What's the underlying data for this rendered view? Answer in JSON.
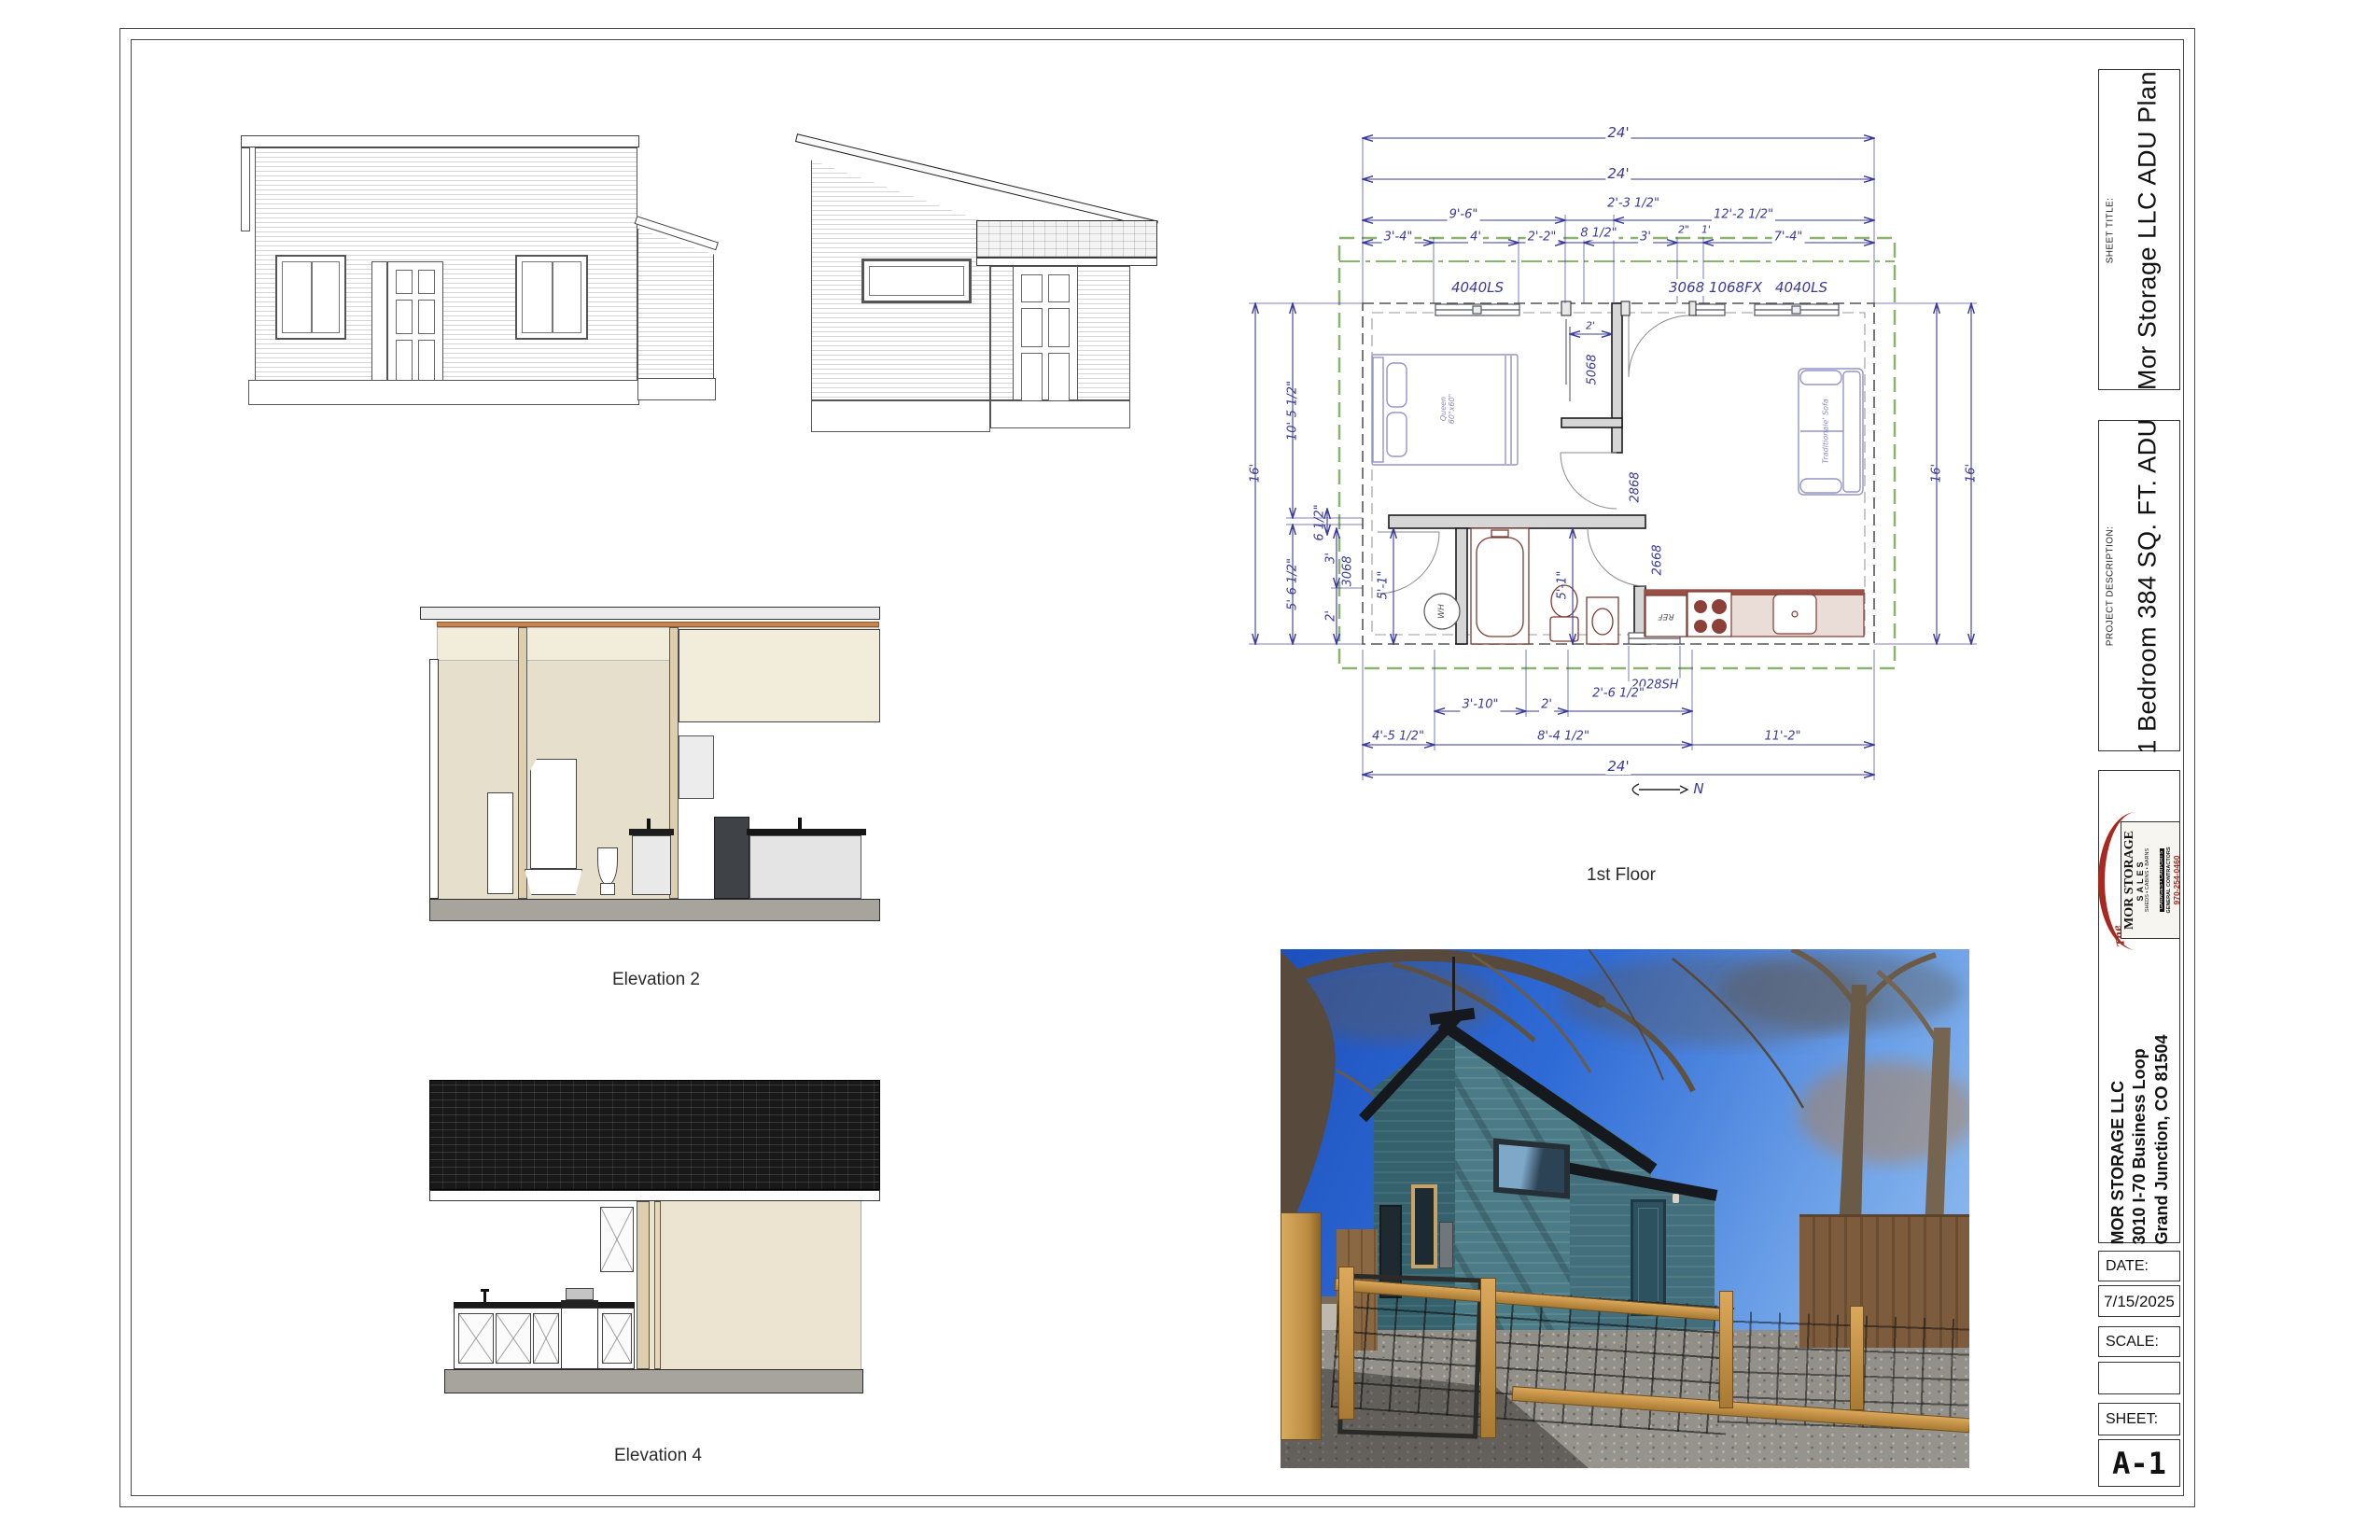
{
  "titleblock": {
    "sheet_title_label": "SHEET TITLE:",
    "sheet_title": "Mor Storage LLC ADU Plan",
    "project_description_label": "PROJECT DESCRIPTION:",
    "project_description": "1 Bedroom 384 SQ. FT. ADU",
    "logo": {
      "prefix": "The",
      "brand": "MOR STORAGE",
      "sub": "SALES",
      "products1": "SHEDS • CABINS • BARNS",
      "products2": "GARAGES • CARPORTS",
      "role": "GENERAL CONTRACTORS",
      "phone": "970-254-0460"
    },
    "company_name": "MOR STORAGE LLC",
    "company_address1": "3010 I-70 Business Loop",
    "company_address2": "Grand Junction, CO 81504",
    "date_label": "DATE:",
    "date_value": "7/15/2025",
    "scale_label": "SCALE:",
    "scale_value": "",
    "sheet_label": "SHEET:",
    "sheet_number": "A-1"
  },
  "plan": {
    "caption": "1st Floor",
    "north_label": "N",
    "dims": {
      "t24a": "24'",
      "t24b": "24'",
      "t96": "9'-6\"",
      "t2312": "2'-3 1/2\"",
      "t12212": "12'-2 1/2\"",
      "t34": "3'-4\"",
      "t4": "4'",
      "t22": "2'-2\"",
      "t812": "8 1/2\"",
      "t3": "3'",
      "t2in": "2\"",
      "t1": "1'",
      "t74": "7'-4\"",
      "l16": "16'",
      "l10512": "10'-5 1/2\"",
      "l612": "6 1/2\"",
      "l5612": "5'-6 1/2\"",
      "l3": "3'",
      "l2": "2'",
      "r16a": "16'",
      "r16b": "16'",
      "b310": "3'-10\"",
      "b2": "2'",
      "b2612": "2'-6 1/2\"",
      "b4512": "4'-5 1/2\"",
      "b8412": "8'-4 1/2\"",
      "b112": "11'-2\"",
      "b24": "24'",
      "closet_w": "2'",
      "bath_a": "5'-1\"",
      "bath_b": "5'-1\""
    },
    "labels": {
      "window_left": "4040LS",
      "door_window_front": "3068 1068FX",
      "window_right": "4040LS",
      "closet_door": "5068",
      "bedroom_door": "2868",
      "side_door": "2668",
      "bath_door": "3068",
      "bottom_window": "2028SH",
      "water_heater": "WH",
      "refrigerator": "REF",
      "bed": "Queen\n60\"x60\"",
      "sofa": "Traditionale' Sofa"
    }
  },
  "elevations": {
    "elevation2_caption": "Elevation 2",
    "elevation4_caption": "Elevation 4"
  }
}
